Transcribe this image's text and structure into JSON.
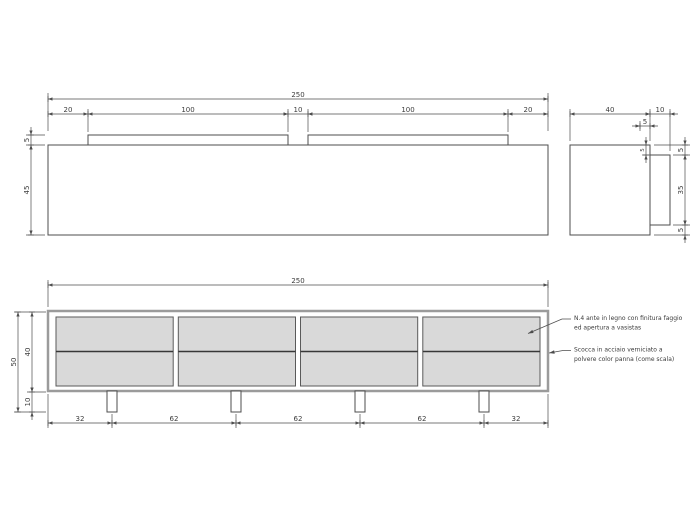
{
  "drawing": {
    "plan_view": {
      "overall_width": "250",
      "top_segments": [
        "20",
        "100",
        "10",
        "100",
        "20"
      ],
      "rail_depth": "5",
      "body_depth": "45"
    },
    "side_view": {
      "body_depth": "40",
      "door_thickness": "10",
      "rail_inset": "5",
      "door_top_offset": "5",
      "right_heights": [
        "5",
        "35",
        "5"
      ]
    },
    "front_view": {
      "overall_width": "250",
      "total_height": "50",
      "body_height": "40",
      "leg_height": "10",
      "leg_spacing": [
        "32",
        "62",
        "62",
        "62",
        "32"
      ]
    },
    "notes": {
      "doors_line1": "N.4 ante in legno con finitura faggio",
      "doors_line2": "ed apertura a vasistas",
      "shell_line1": "Scocca in acciaio verniciato a",
      "shell_line2": "polvere color panna (come scala)"
    },
    "colors": {
      "line": "#4d4d4d",
      "panel_fill": "#d9d9d9",
      "frame_stroke": "#9b9b9b",
      "text": "#3c3c3c",
      "background": "#ffffff"
    }
  }
}
